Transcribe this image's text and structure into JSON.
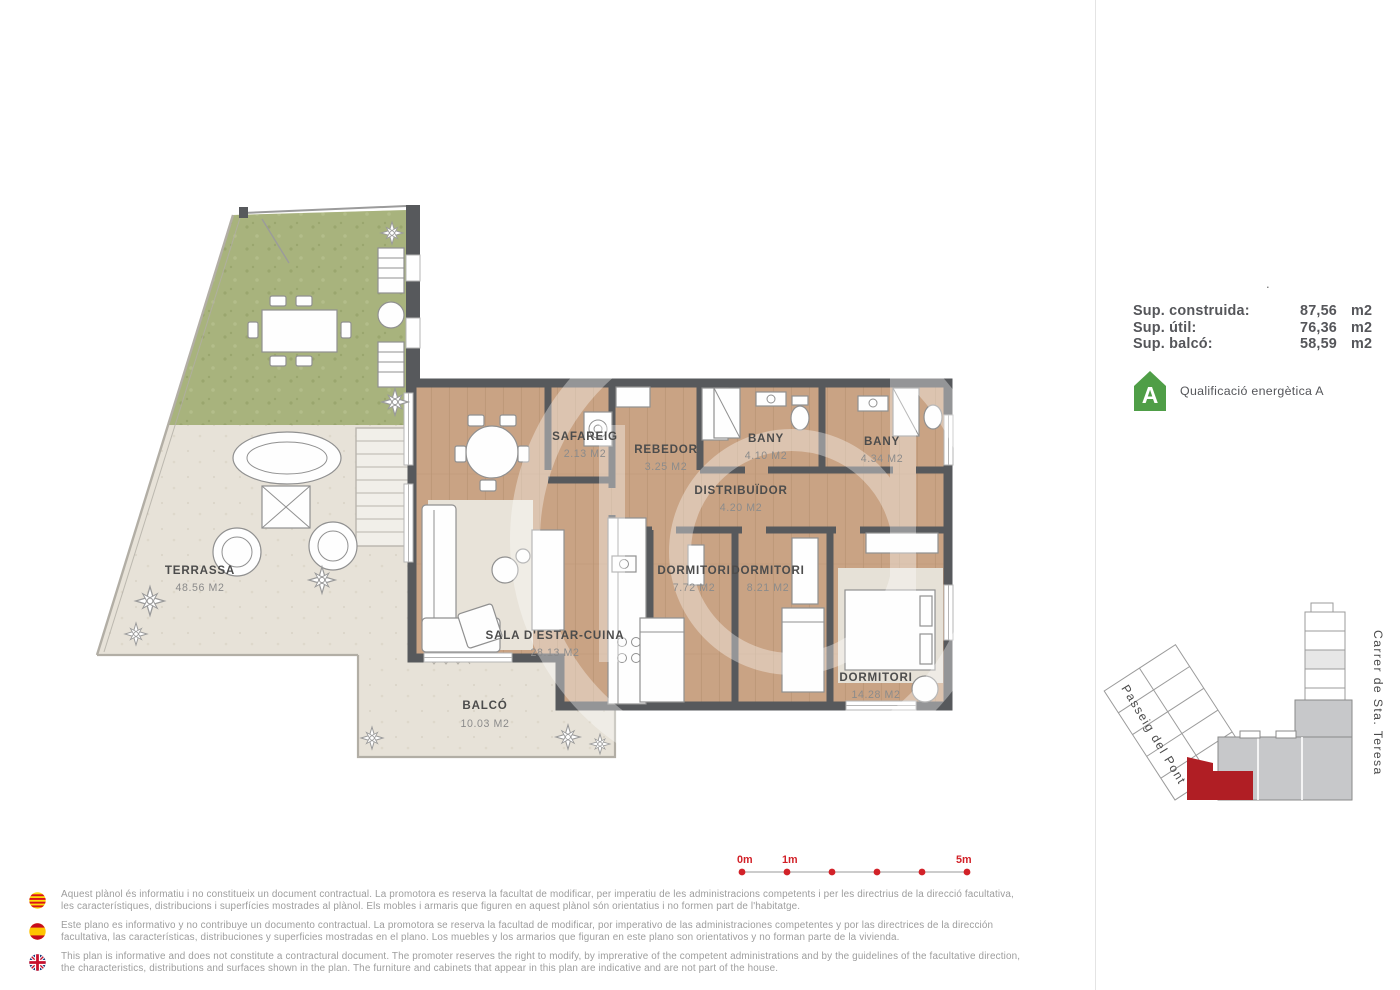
{
  "plan": {
    "rooms": [
      {
        "name": "TERRASSA",
        "area": "48.56 M2"
      },
      {
        "name": "SAFAREIG",
        "area": "2.13 M2"
      },
      {
        "name": "REBEDOR",
        "area": "3.25 M2"
      },
      {
        "name": "BANY",
        "area": "4.10 M2"
      },
      {
        "name": "BANY",
        "area": "4.34 M2"
      },
      {
        "name": "DISTRIBUÏDOR",
        "area": "4.20 M2"
      },
      {
        "name": "DORMITORI",
        "area": "7.72 M2"
      },
      {
        "name": "DORMITORI",
        "area": "8.21 M2"
      },
      {
        "name": "DORMITORI",
        "area": "14.28 M2"
      },
      {
        "name": "SALA D'ESTAR-CUINA",
        "area": "28.13 M2"
      },
      {
        "name": "BALCÓ",
        "area": "10.03 M2"
      }
    ],
    "wall_color": "#57595c",
    "wood_color": "#c9a384",
    "grass_color": "#a8b37d"
  },
  "panel": {
    "surface_rows": [
      {
        "label": "Sup. construida:",
        "value": "87,56",
        "unit": "m2"
      },
      {
        "label": "Sup. útil:",
        "value": "76,36",
        "unit": "m2"
      },
      {
        "label": "Sup. balcó:",
        "value": "58,59",
        "unit": "m2"
      }
    ],
    "energy_rating": {
      "letter": "A",
      "label": "Qualificació energètica A",
      "color": "#4f9e47"
    },
    "stray_dot": "."
  },
  "site_map": {
    "street_left": "Passeig del Pont",
    "street_right": "Carrer de Sta. Teresa",
    "highlight_color": "#b01e24"
  },
  "scale_bar": {
    "labels": {
      "start": "0m",
      "first": "1m",
      "end": "5m"
    },
    "color": "#d22128"
  },
  "disclaimers": [
    {
      "flag": "catalonia-flag",
      "text": "Aquest plànol és informatiu i no constitueix un document contractual. La promotora es reserva la facultat de modificar, per imperatiu de les administracions competents i per les directrius de la direcció facultativa, les característiques, distribucions i superfícies mostrades al plànol. Els mobles i armaris que figuren en aquest plànol són orientatius i no formen part de l'habitatge."
    },
    {
      "flag": "spain-flag",
      "text": "Este plano es informativo y no contribuye un documento contractual. La promotora se reserva la facultad de modificar, por imperativo de las administraciones competentes y por las directrices de la dirección facultativa, las características, distribuciones y superficies mostradas en el plano. Los muebles y los armarios que figuran en este plano son orientativos y no forman parte de la vivienda."
    },
    {
      "flag": "uk-flag",
      "text": "This plan is informative and does not constitute a contractural document. The promoter reserves the right to modify, by imprerative of the competent administrations and by the guidelines of the facultative direction, the characteristics, distributions and surfaces shown in the plan. The furniture and cabinets that appear in this plan are indicative and are not part of the house."
    }
  ]
}
